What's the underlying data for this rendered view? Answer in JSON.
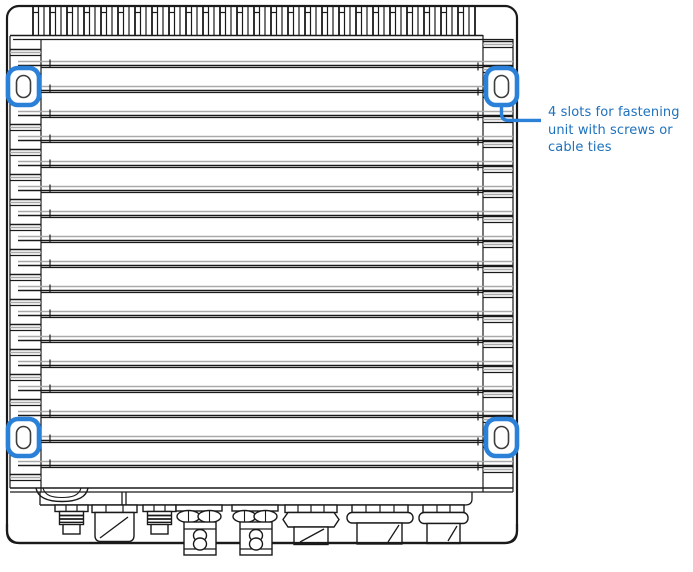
{
  "figure": {
    "annotation": {
      "lines": [
        "4 slots for fastening",
        "unit with screws or",
        "cable ties"
      ],
      "full_text": "4 slots for fastening unit with screws or cable ties"
    },
    "slots": {
      "count": 4,
      "positions": [
        "top-left",
        "top-right",
        "bottom-left",
        "bottom-right"
      ]
    },
    "colors": {
      "highlight_blue": "#2b80d8",
      "annotation_text_blue": "#1d71bd",
      "drawing_line": "#1a1a1a",
      "drawing_shadow_gray": "#a9a9a9",
      "background": "#ffffff"
    }
  }
}
